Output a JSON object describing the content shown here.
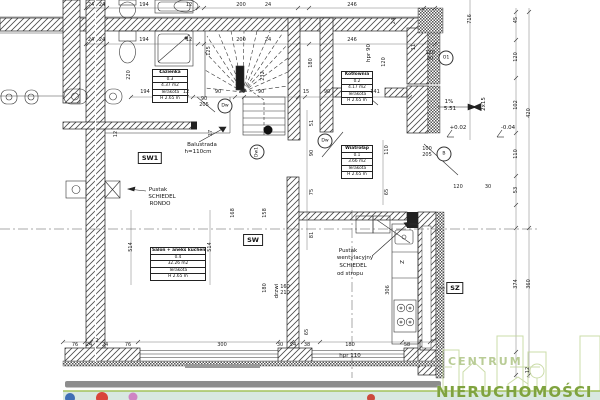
{
  "watermark": {
    "brand_top": "CENTRUM",
    "brand_bottom": "NIERUCHOMOŚCI"
  },
  "room_tables": [
    {
      "name": "Łazienka",
      "number": "0.3",
      "area": "4.37 m2",
      "floor": "Terakota",
      "height": "H 2.65 m"
    },
    {
      "name": "Kotłownia",
      "number": "0.2",
      "area": "4.17 m2",
      "floor": "Terakota",
      "height": "H 2.65 m"
    },
    {
      "name": "Wiatrołap",
      "number": "0.1",
      "area": "3.66 m2",
      "floor": "Terakota",
      "height": "H 2.65 m"
    },
    {
      "name": "Salon + aneks kuchenny",
      "number": "0.4",
      "area": "32.26 m2",
      "floor": "Terakota",
      "height": "H 2.65 m"
    }
  ],
  "boxed_labels": [
    {
      "text": "SW1",
      "x": 150,
      "y": 158
    },
    {
      "text": "SW",
      "x": 253,
      "y": 240
    },
    {
      "text": "SZ",
      "x": 455,
      "y": 288
    }
  ],
  "circle_labels": [
    {
      "text": "O1",
      "x": 446,
      "y": 58
    },
    {
      "text": "B",
      "x": 444,
      "y": 154
    },
    {
      "text": "Dw",
      "x": 325,
      "y": 141
    },
    {
      "text": "Dw",
      "x": 225,
      "y": 106
    },
    {
      "text": "Dw1",
      "x": 257,
      "y": 152,
      "r": 1
    }
  ],
  "annotations": [
    {
      "text": "Balustrada",
      "x": 202,
      "y": 145
    },
    {
      "text": "h=110cm",
      "x": 198,
      "y": 152
    },
    {
      "text": "Pustak",
      "x": 158,
      "y": 190
    },
    {
      "text": "SCHIEDEL",
      "x": 162,
      "y": 197
    },
    {
      "text": "RONDO",
      "x": 160,
      "y": 204
    },
    {
      "text": "Pustak",
      "x": 348,
      "y": 251
    },
    {
      "text": "wentylacyjny",
      "x": 355,
      "y": 258
    },
    {
      "text": "SCHIEDEL",
      "x": 353,
      "y": 266
    },
    {
      "text": "od stropu",
      "x": 350,
      "y": 274
    },
    {
      "text": "+0.02",
      "x": 458,
      "y": 128
    },
    {
      "text": "-0.04",
      "x": 508,
      "y": 128
    },
    {
      "text": "1%",
      "x": 449,
      "y": 102
    },
    {
      "text": "5.51",
      "x": 450,
      "y": 109
    },
    {
      "text": "2x15",
      "x": 484,
      "y": 104,
      "r": 1
    },
    {
      "text": "hpr 110",
      "x": 350,
      "y": 356
    },
    {
      "text": "hpr 90",
      "x": 369,
      "y": 53,
      "r": 1
    },
    {
      "text": "drzwi",
      "x": 277,
      "y": 291,
      "r": 1
    },
    {
      "text": "Z",
      "x": 403,
      "y": 262,
      "r": 1
    }
  ],
  "dims": [
    {
      "t": "24",
      "x": 91,
      "y": 5
    },
    {
      "t": "24",
      "x": 102,
      "y": 5
    },
    {
      "t": "194",
      "x": 144,
      "y": 5
    },
    {
      "t": "12",
      "x": 189,
      "y": 5
    },
    {
      "t": "200",
      "x": 241,
      "y": 5
    },
    {
      "t": "24",
      "x": 268,
      "y": 5
    },
    {
      "t": "246",
      "x": 352,
      "y": 5
    },
    {
      "t": "24",
      "x": 91,
      "y": 40
    },
    {
      "t": "24",
      "x": 102,
      "y": 40
    },
    {
      "t": "194",
      "x": 144,
      "y": 40
    },
    {
      "t": "12",
      "x": 189,
      "y": 40
    },
    {
      "t": "200",
      "x": 241,
      "y": 40
    },
    {
      "t": "24",
      "x": 268,
      "y": 40
    },
    {
      "t": "246",
      "x": 352,
      "y": 40
    },
    {
      "t": "11",
      "x": 414,
      "y": 47,
      "r": 1
    },
    {
      "t": "24",
      "x": 394,
      "y": 21,
      "r": 1
    },
    {
      "t": "194",
      "x": 145,
      "y": 92
    },
    {
      "t": "12",
      "x": 186,
      "y": 92
    },
    {
      "t": "90",
      "x": 218,
      "y": 92
    },
    {
      "t": "20",
      "x": 242,
      "y": 92
    },
    {
      "t": "90",
      "x": 261,
      "y": 92
    },
    {
      "t": "15",
      "x": 306,
      "y": 92
    },
    {
      "t": "90",
      "x": 327,
      "y": 92
    },
    {
      "t": "141",
      "x": 375,
      "y": 92
    },
    {
      "t": "90",
      "x": 204,
      "y": 99
    },
    {
      "t": "205",
      "x": 204,
      "y": 105
    },
    {
      "t": "120",
      "x": 430,
      "y": 53
    },
    {
      "t": "80",
      "x": 430,
      "y": 59
    },
    {
      "t": "100",
      "x": 427,
      "y": 149
    },
    {
      "t": "205",
      "x": 427,
      "y": 155
    },
    {
      "t": "220",
      "x": 129,
      "y": 75,
      "r": 1
    },
    {
      "t": "125",
      "x": 209,
      "y": 51,
      "r": 1
    },
    {
      "t": "232",
      "x": 263,
      "y": 76,
      "r": 1
    },
    {
      "t": "17",
      "x": 211,
      "y": 133,
      "r": 1
    },
    {
      "t": "12",
      "x": 116,
      "y": 134,
      "r": 1
    },
    {
      "t": "180",
      "x": 311,
      "y": 63,
      "r": 1
    },
    {
      "t": "120",
      "x": 384,
      "y": 62,
      "r": 1
    },
    {
      "t": "716",
      "x": 470,
      "y": 19,
      "r": 1
    },
    {
      "t": "45",
      "x": 516,
      "y": 20,
      "r": 1
    },
    {
      "t": "120",
      "x": 516,
      "y": 57,
      "r": 1
    },
    {
      "t": "102",
      "x": 516,
      "y": 105,
      "r": 1
    },
    {
      "t": "110",
      "x": 516,
      "y": 154,
      "r": 1
    },
    {
      "t": "53",
      "x": 516,
      "y": 190,
      "r": 1
    },
    {
      "t": "420",
      "x": 529,
      "y": 113,
      "r": 1
    },
    {
      "t": "374",
      "x": 516,
      "y": 284,
      "r": 1
    },
    {
      "t": "360",
      "x": 529,
      "y": 284,
      "r": 1
    },
    {
      "t": "12",
      "x": 528,
      "y": 370,
      "r": 1
    },
    {
      "t": "51",
      "x": 312,
      "y": 123,
      "r": 1
    },
    {
      "t": "90",
      "x": 312,
      "y": 153,
      "r": 1
    },
    {
      "t": "75",
      "x": 312,
      "y": 192,
      "r": 1
    },
    {
      "t": "81",
      "x": 312,
      "y": 235,
      "r": 1
    },
    {
      "t": "110",
      "x": 387,
      "y": 150,
      "r": 1
    },
    {
      "t": "65",
      "x": 387,
      "y": 192,
      "r": 1
    },
    {
      "t": "168",
      "x": 233,
      "y": 213,
      "r": 1
    },
    {
      "t": "158",
      "x": 265,
      "y": 213,
      "r": 1
    },
    {
      "t": "514",
      "x": 131,
      "y": 247,
      "r": 1
    },
    {
      "t": "514",
      "x": 210,
      "y": 247,
      "r": 1
    },
    {
      "t": "306",
      "x": 388,
      "y": 290,
      "r": 1
    },
    {
      "t": "180",
      "x": 265,
      "y": 288,
      "r": 1
    },
    {
      "t": "65",
      "x": 307,
      "y": 332,
      "r": 1
    },
    {
      "t": "160",
      "x": 285,
      "y": 287
    },
    {
      "t": "210",
      "x": 285,
      "y": 293
    },
    {
      "t": "120",
      "x": 458,
      "y": 187
    },
    {
      "t": "30",
      "x": 488,
      "y": 187
    },
    {
      "t": "76",
      "x": 75,
      "y": 345
    },
    {
      "t": "24",
      "x": 89,
      "y": 345
    },
    {
      "t": "2",
      "x": 97,
      "y": 341
    },
    {
      "t": "24",
      "x": 105,
      "y": 345
    },
    {
      "t": "76",
      "x": 128,
      "y": 345
    },
    {
      "t": "300",
      "x": 222,
      "y": 345
    },
    {
      "t": "30",
      "x": 280,
      "y": 345
    },
    {
      "t": "24",
      "x": 293,
      "y": 345
    },
    {
      "t": "38",
      "x": 307,
      "y": 345
    },
    {
      "t": "180",
      "x": 350,
      "y": 345
    },
    {
      "t": "58",
      "x": 407,
      "y": 345
    }
  ]
}
